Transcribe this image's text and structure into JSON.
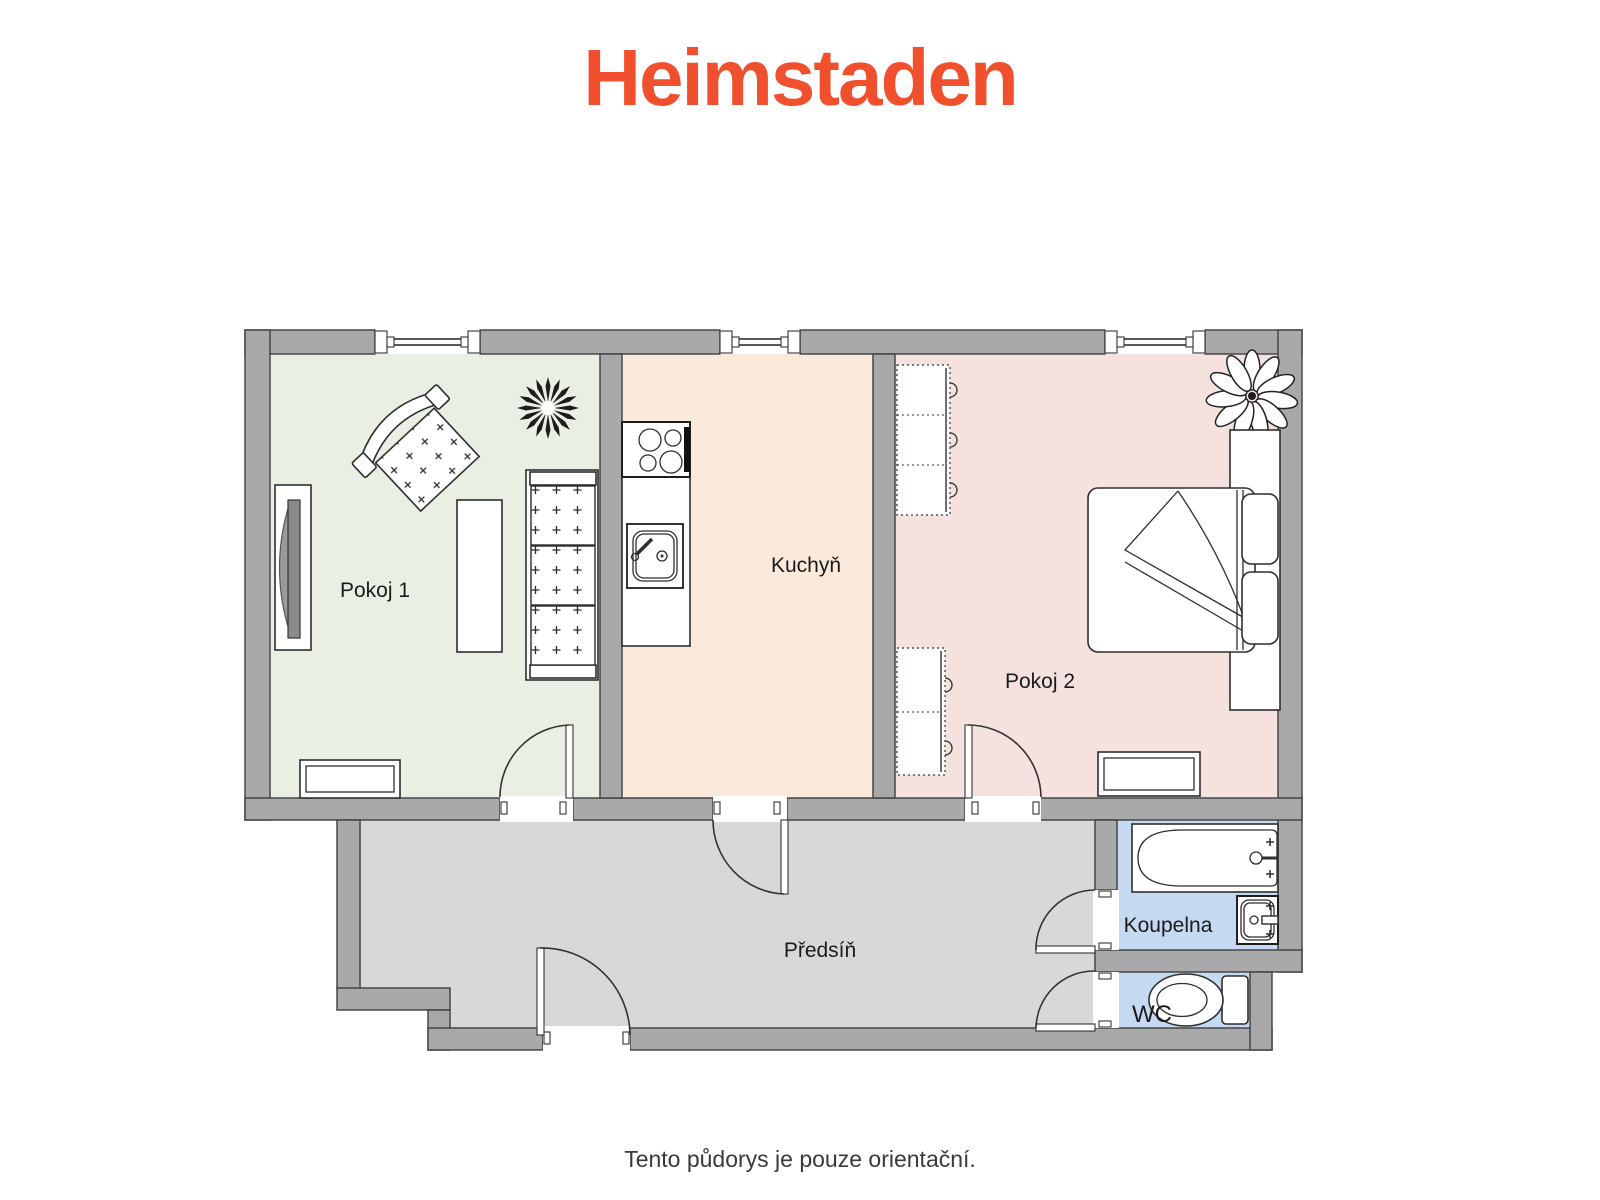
{
  "logo": {
    "text": "Heimstaden",
    "color": "#F0502D"
  },
  "caption": "Tento půdorys je pouze orientační.",
  "plan": {
    "rooms": {
      "pokoj1": {
        "label": "Pokoj 1",
        "floor_color": "#E9EFE2"
      },
      "kuchyn": {
        "label": "Kuchyň",
        "floor_color": "#FBE9DC"
      },
      "pokoj2": {
        "label": "Pokoj 2",
        "floor_color": "#F5E2DF"
      },
      "predsin": {
        "label": "Předsíň",
        "floor_color": "#D8D8D8"
      },
      "koupelna": {
        "label": "Koupelna",
        "floor_color": "#C5D9F0"
      },
      "wc": {
        "label": "WC",
        "floor_color": "#C5D9F0"
      }
    },
    "colors": {
      "wall_fill": "#A9A9A9",
      "wall_stroke": "#3E3E3E"
    }
  }
}
